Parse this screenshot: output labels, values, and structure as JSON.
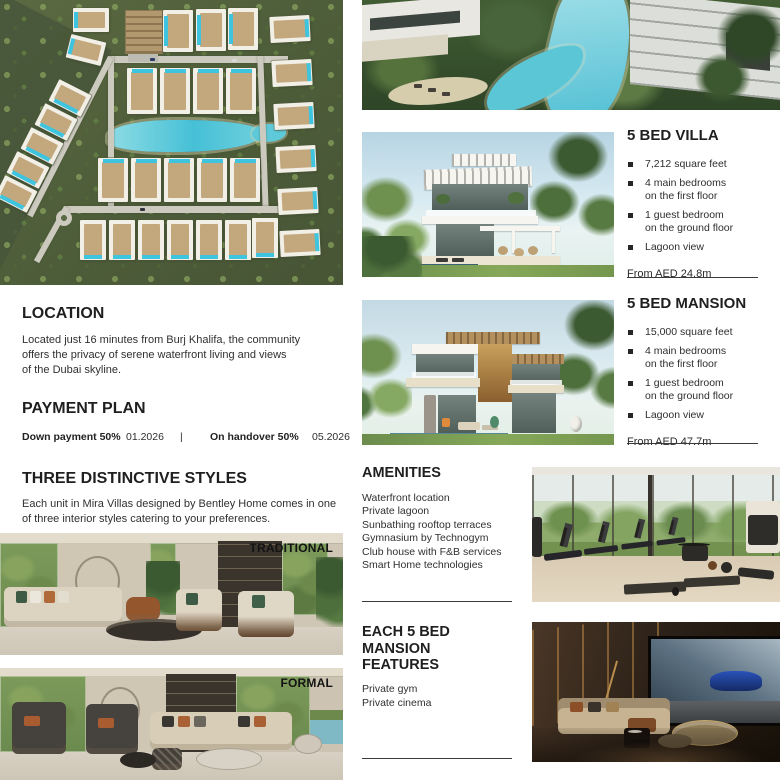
{
  "villa_section": {
    "title": "5 BED VILLA",
    "bullets": [
      "7,212 square feet",
      "4 main bedrooms\non the first floor",
      "1 guest bedroom\non the ground floor",
      "Lagoon view"
    ],
    "price": "From AED 24.8m"
  },
  "mansion_section": {
    "title": "5 BED MANSION",
    "bullets": [
      "15,000 square feet",
      "4 main bedrooms\non the first floor",
      "1 guest bedroom\non the ground floor",
      "Lagoon view"
    ],
    "price": "From AED 47.7m"
  },
  "location": {
    "title": "LOCATION",
    "body": "Located just 16 minutes from Burj Khalifa, the community\noffers the privacy of serene waterfront living and views\nof the Dubai skyline."
  },
  "payment": {
    "title": "PAYMENT PLAN",
    "down_label": "Down payment 50%",
    "down_date": "01.2026",
    "separator": "|",
    "handover_label": "On handover 50%",
    "handover_date": "05.2026"
  },
  "styles": {
    "title": "THREE DISTINCTIVE STYLES",
    "body": "Each unit in Mira Villas designed by Bentley Home comes in one\nof three interior styles catering to your preferences.",
    "label_traditional": "TRADITIONAL",
    "label_formal": "FORMAL"
  },
  "amenities": {
    "title": "AMENITIES",
    "items": [
      "Waterfront location",
      "Private lagoon",
      "Sunbathing rooftop terraces",
      "Gymnasium by Technogym",
      "Club house with F&B services",
      "Smart Home technologies"
    ]
  },
  "features": {
    "title": "EACH 5 BED\nMANSION\nFEATURES",
    "items": [
      "Private gym",
      "Private cinema"
    ]
  },
  "colors": {
    "heading_text": "#1f1f1f",
    "body_text": "#303030",
    "pool_cyan": "#3ec4de",
    "grass_green": "#5b6a42"
  }
}
